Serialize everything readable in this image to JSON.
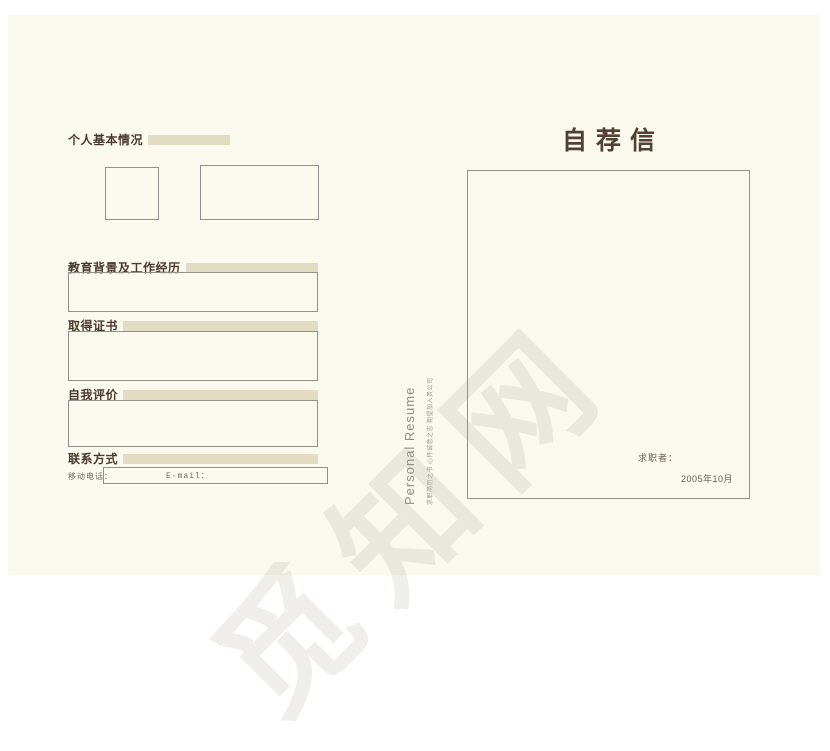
{
  "page": {
    "background_color": "#faf9ee",
    "accent_bar_color": "#e2dcc3",
    "heading_color": "#4a3a2c",
    "box_border_color": "#8f8f8f"
  },
  "left_page": {
    "sections": [
      {
        "title": "个人基本情况"
      },
      {
        "title": "教育背景及工作经历"
      },
      {
        "title": "取得证书"
      },
      {
        "title": "自我评价"
      },
      {
        "title": "联系方式"
      }
    ],
    "contact": {
      "mobile_label": "移动电话：",
      "email_label": "E-mail："
    }
  },
  "spine": {
    "vertical_title": "Personal Resume",
    "vertical_subtitle": "求职简历之书 心怀诚意之志 期望加入贵公司"
  },
  "right_page": {
    "title": "自荐信",
    "applicant_label": "求职者：",
    "date": "2005年10月"
  },
  "watermark": {
    "text": "觅知网"
  }
}
